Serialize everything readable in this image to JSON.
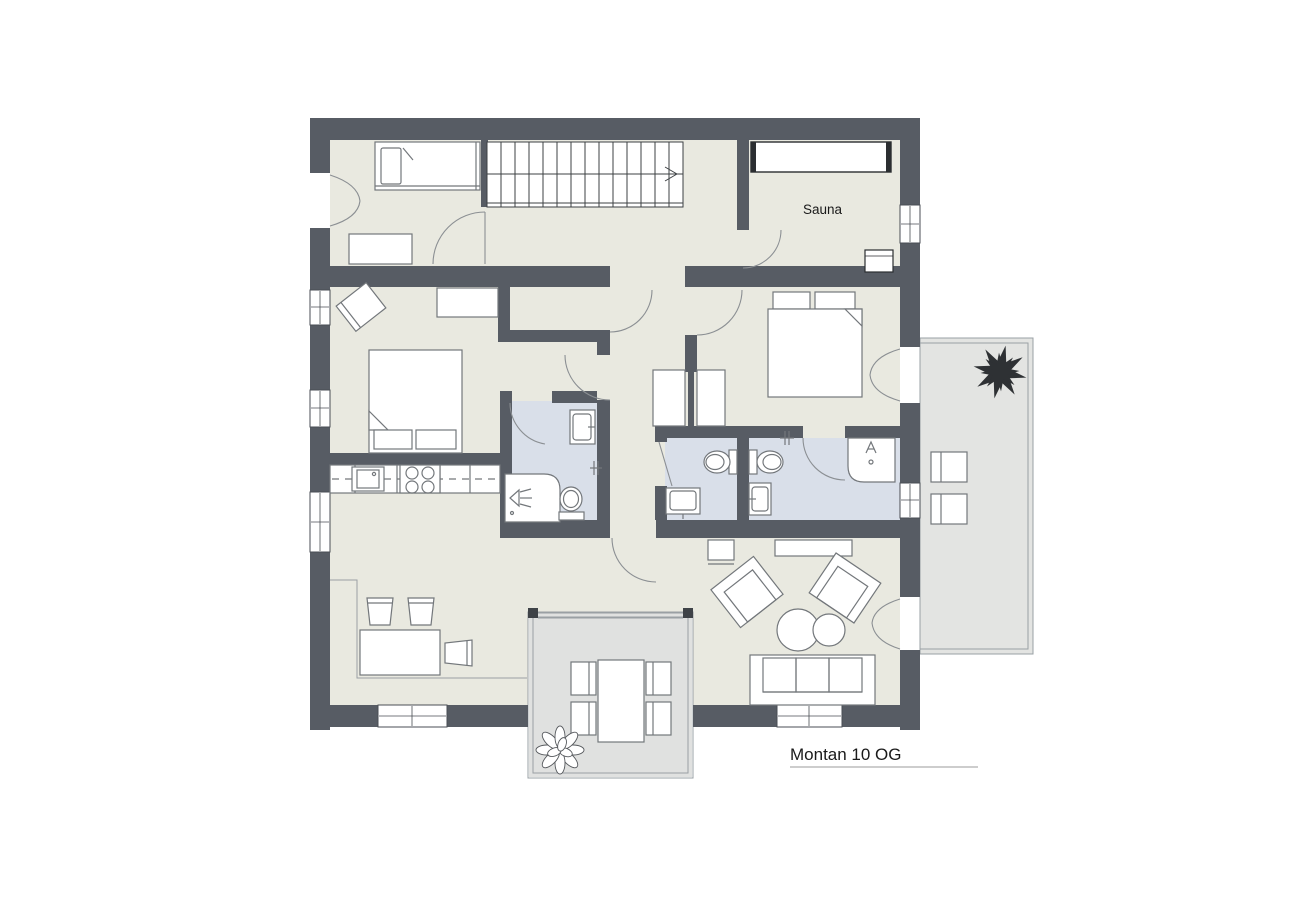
{
  "title": {
    "label": "Montan 10 OG"
  },
  "rooms": {
    "sauna_label": "Sauna"
  },
  "colors": {
    "background": "#ffffff",
    "wall": "#575c64",
    "floor": "#e9e9e0",
    "bathroom_floor": "#d9dfe9",
    "terrace_floor": "#e3e4e2",
    "balcony_floor": "#e0e1e0",
    "furniture_outline": "#73777b",
    "plant_dark": "#2e3134",
    "text": "#1a1a1a"
  }
}
